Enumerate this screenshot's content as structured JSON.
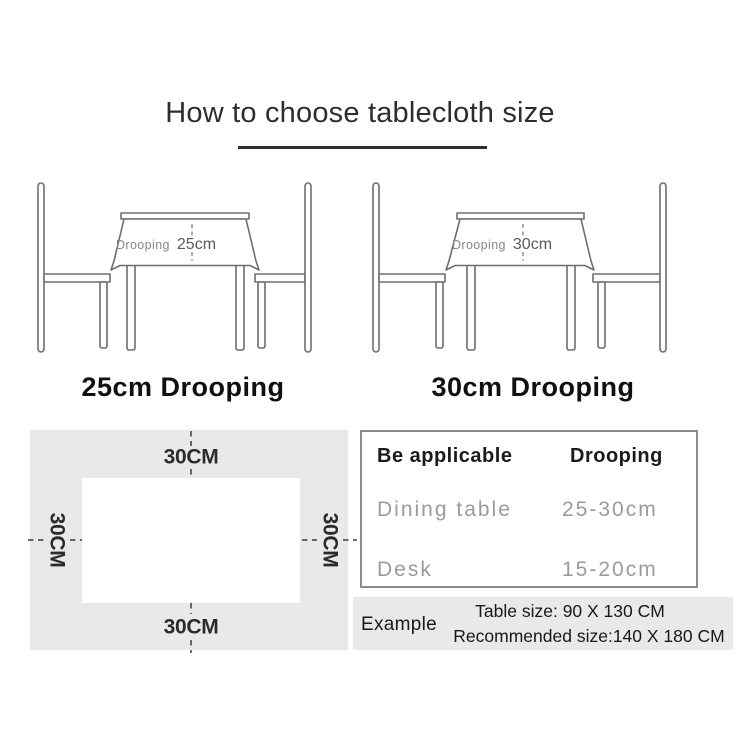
{
  "title": "How to choose tablecloth size",
  "scenes": [
    {
      "drooping_prefix": "Drooping",
      "drooping_value": "25cm",
      "caption": "25cm Drooping"
    },
    {
      "drooping_prefix": "Drooping",
      "drooping_value": "30cm",
      "caption": "30cm Drooping"
    }
  ],
  "size_diagram": {
    "top_label": "30CM",
    "bottom_label": "30CM",
    "left_label": "30CM",
    "right_label": "30CM"
  },
  "spec_table": {
    "col1_header": "Be applicable",
    "col2_header": "Drooping",
    "rows": [
      {
        "name": "Dining table",
        "value": "25-30cm"
      },
      {
        "name": "Desk",
        "value": "15-20cm"
      }
    ]
  },
  "example": {
    "label": "Example",
    "table_size": "Table size:  90 X 130 CM",
    "recommended_size": "Recommended size:140 X 180 CM"
  },
  "colors": {
    "line_art_gray": "#6e6e6e",
    "panel_gray": "#e9e9e9",
    "text_dark": "#1b1b1b",
    "muted_text_gray": "#9b9b9b"
  }
}
